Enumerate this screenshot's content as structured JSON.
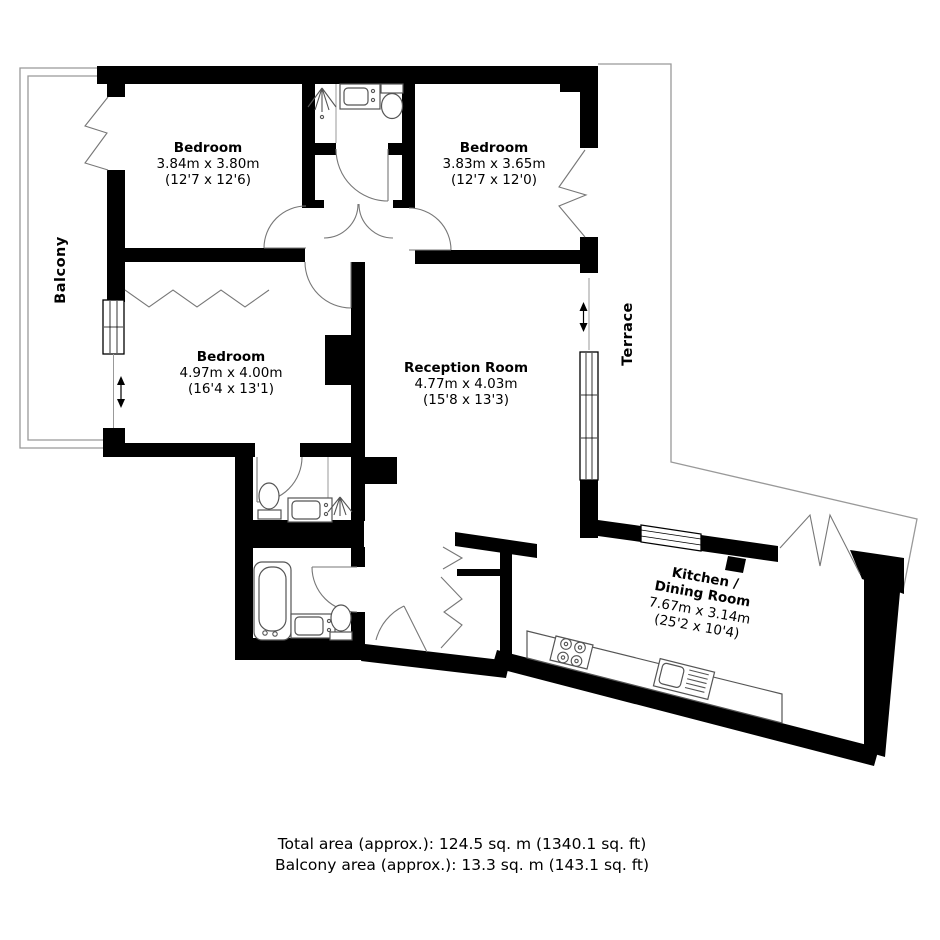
{
  "plan": {
    "rooms": {
      "bedroom1": {
        "name": "Bedroom",
        "metric": "3.84m x 3.80m",
        "imperial": "(12'7 x 12'6)"
      },
      "bedroom2": {
        "name": "Bedroom",
        "metric": "3.83m x 3.65m",
        "imperial": "(12'7 x 12'0)"
      },
      "bedroom3": {
        "name": "Bedroom",
        "metric": "4.97m x 4.00m",
        "imperial": "(16'4 x 13'1)"
      },
      "reception": {
        "name": "Reception Room",
        "metric": "4.77m x 4.03m",
        "imperial": "(15'8 x 13'3)"
      },
      "kitchen": {
        "name_line1": "Kitchen /",
        "name_line2": "Dining Room",
        "metric": "7.67m x 3.14m",
        "imperial": "(25'2 x 10'4)"
      }
    },
    "outdoor": {
      "balcony": {
        "label": "Balcony"
      },
      "terrace": {
        "label": "Terrace"
      }
    },
    "footer": {
      "total_area": "Total area (approx.): 124.5 sq. m (1340.1 sq. ft)",
      "balcony_area": "Balcony area (approx.): 13.3 sq. m (143.1 sq. ft)"
    },
    "colors": {
      "wall": "#000000",
      "fixture": "#555555",
      "door_arc": "#777777",
      "outline": "#999999",
      "background": "#ffffff"
    }
  }
}
